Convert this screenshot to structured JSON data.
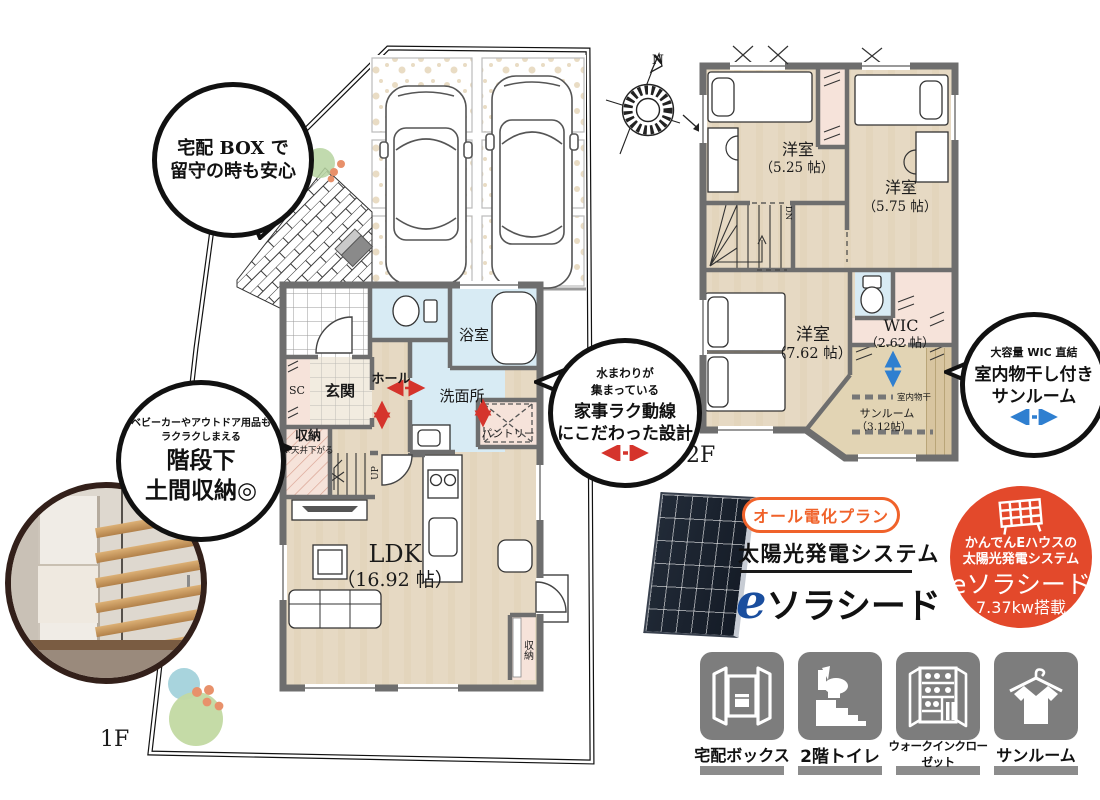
{
  "plans": {
    "floor1": {
      "tag": "1F",
      "ldk": "LDK",
      "ldk_size": "（16.92 帖）",
      "genkan": "玄関",
      "hall": "ホール",
      "bath": "浴室",
      "washroom": "洗面所",
      "storage": "収納",
      "storage_note": "※天井下がる",
      "pantry": "パントリー",
      "shoes_closet": "SC",
      "up": "UP",
      "closet": "収納"
    },
    "floor2": {
      "tag": "2F",
      "room_a": "洋室",
      "room_a_size": "（5.25 帖）",
      "room_b": "洋室",
      "room_b_size": "（5.75 帖）",
      "room_c": "洋室",
      "room_c_size": "（7.62 帖）",
      "wic": "WIC",
      "wic_size": "（2.62 帖）",
      "sunroom": "サンルーム",
      "sunroom_size": "（3.12帖）",
      "drying_rod": "室内物干",
      "dn": "DN"
    },
    "compass_n": "N"
  },
  "bubbles": {
    "delivery": {
      "line1": "宅配 BOX で",
      "line2": "留守の時も安心"
    },
    "doma": {
      "small1": "ベビーカーやアウトドア用品も",
      "small2": "ラクラクしまえる",
      "big1": "階段下",
      "big2": "土間収納◎"
    },
    "kaji": {
      "small1": "水まわりが",
      "small2": "集まっている",
      "big1": "家事ラク動線",
      "big2": "にこだわった設計"
    },
    "sun": {
      "small1": "大容量 WIC 直結",
      "big1": "室内物干し付き",
      "big2": "サンルーム"
    }
  },
  "solar": {
    "plan_badge": "オール電化プラン",
    "system": "太陽光発電システム",
    "brand_e": "e",
    "brand_name": "ソラシード"
  },
  "solar_badge": {
    "line1": "かんでんEハウスの",
    "line2": "太陽光発電システム",
    "brand": "eソラシード",
    "capacity": "7.37kw搭載"
  },
  "features": [
    {
      "label": "宅配ボックス",
      "icon": "delivery-box-icon"
    },
    {
      "label": "2階トイレ",
      "icon": "stairs-toilet-icon"
    },
    {
      "label": "ウォークインクローゼット",
      "icon": "walk-in-closet-icon"
    },
    {
      "label": "サンルーム",
      "icon": "shirt-hanger-icon"
    }
  ],
  "colors": {
    "accent_red": "#e3492b",
    "accent_orange": "#f0622a",
    "brand_blue": "#1a4e9e",
    "arrow_red": "#d5342c",
    "arrow_blue": "#2f7fd0",
    "icon_gray": "#7d7d7d",
    "floor": "#e6d9c3",
    "wet_blue": "#d8ebf4",
    "closet_pink": "#f6e3da"
  }
}
